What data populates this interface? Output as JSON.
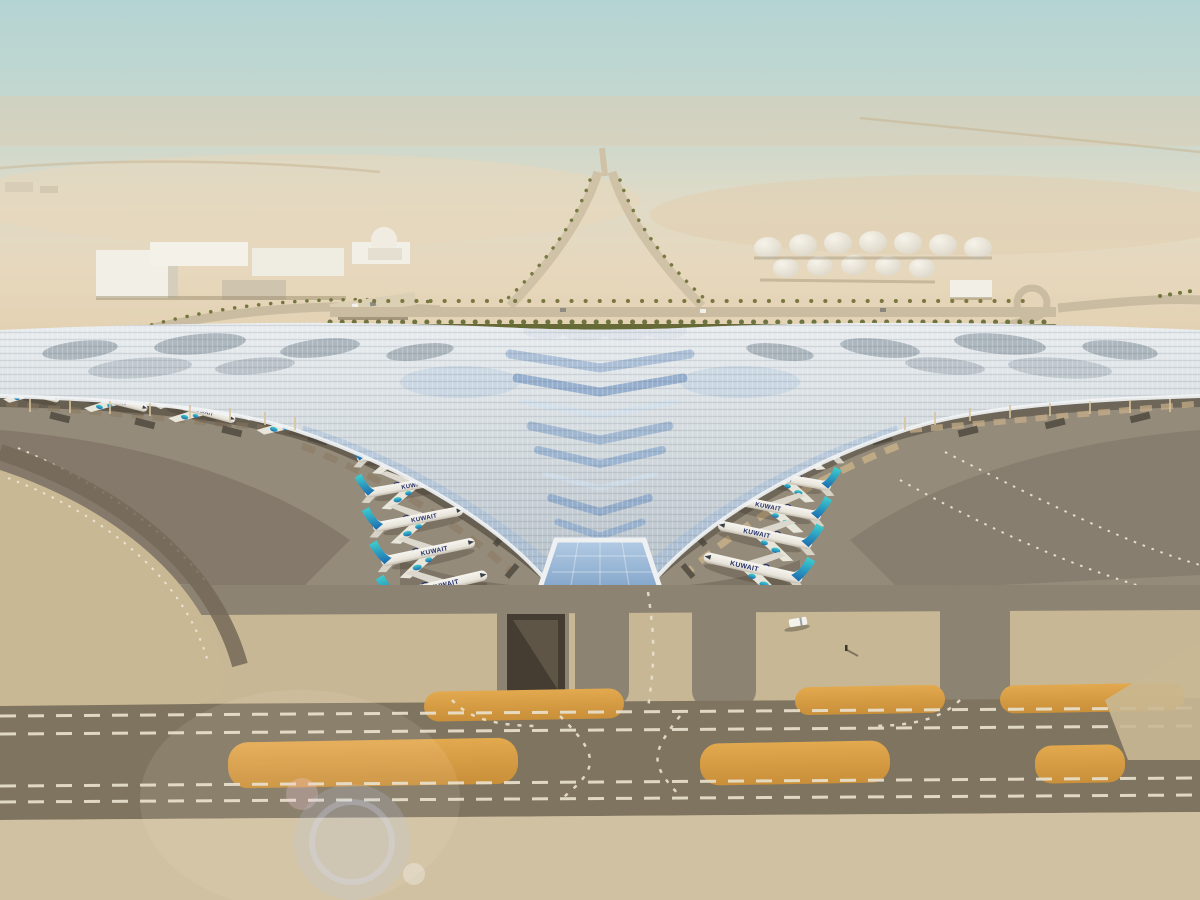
{
  "scene": {
    "description": "Aerial architectural rendering of a desert airport: a huge swooping trident-shaped ribbed terminal roof with blue chevron solar skylights, rows of airline jets parked nose-in along both inner piers and under the outer wings, palm-lined ring roads, a green hedge band, white fuel storage tanks and warehouse buildings behind, and taxiways with orange painted islands and dashed white markings in the foreground under hazy daylight",
    "aircraft_title": "KUWAIT",
    "aircraft_visible": 18,
    "setting": "desert haze, midday",
    "colors": {
      "sky_top": "#b4d4d3",
      "haze": "#e6d8c0",
      "sand": "#ddc9a6",
      "roof_light": "#e9edf0",
      "roof_shade": "#b3bec7",
      "solar_blue": "#8fb0d4",
      "tail_teal": "#3fd0cf",
      "tail_blue": "#1b6ab0",
      "title_navy": "#23306b",
      "apron_gray": "#958b7b",
      "taxiway_dark": "#7e7460",
      "marking_orange": "#dda049",
      "marking_white": "#e9e1cd",
      "hedge_green": "#656a37"
    },
    "features": [
      "swooping winged terminal roof with chevron solar skylights",
      "central glass entrance apex with columns",
      "five jets on each inner pier, four under each outer wing",
      "white cylindrical fuel tanks",
      "warehouse buildings and small dome",
      "palm-lined ring road with overpass and helix ramp",
      "taxiways with double dashed centerlines and orange islands",
      "underground ramp pit and lone service vehicle",
      "lens flare in lower-left corner"
    ]
  }
}
